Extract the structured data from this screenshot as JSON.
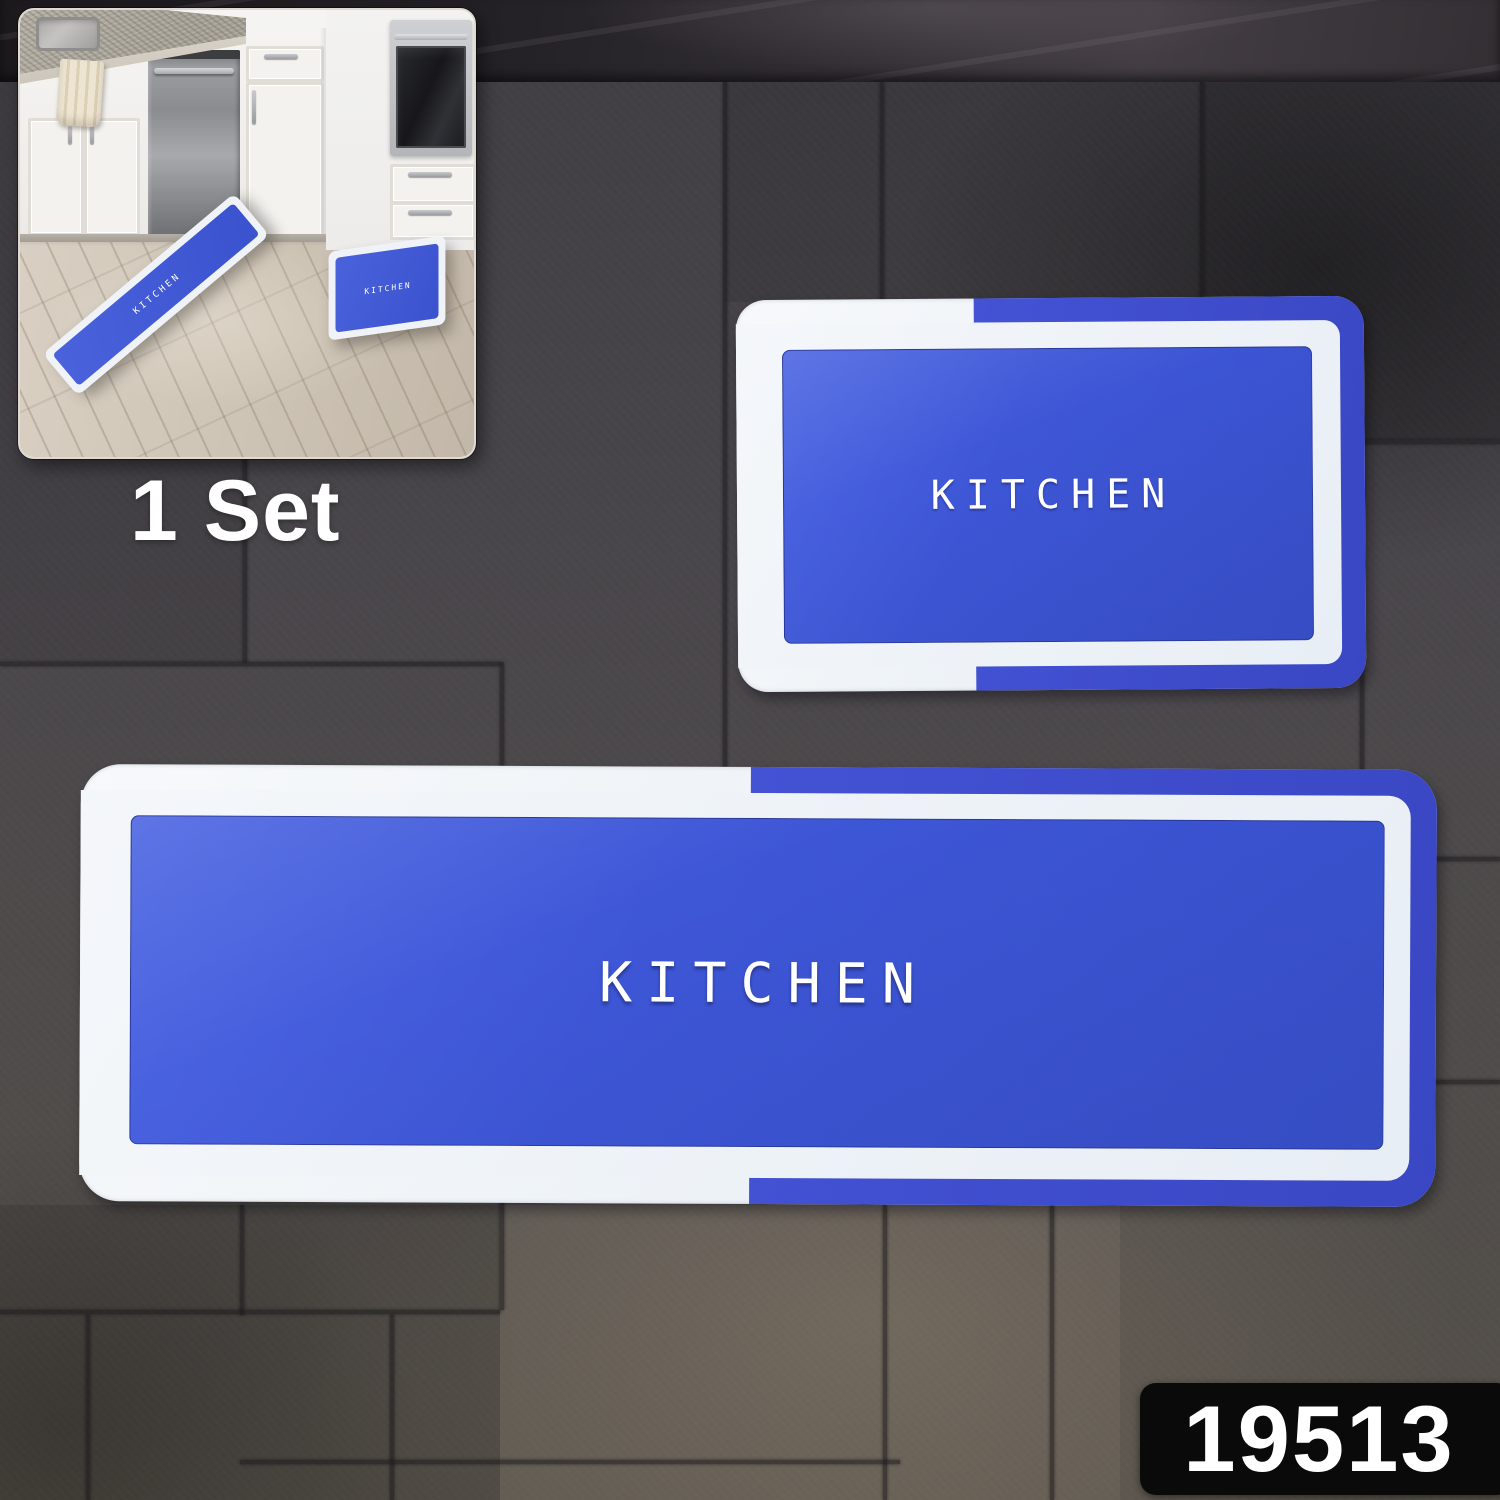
{
  "set_label": "1 Set",
  "product_code": "19513",
  "mat_large": {
    "label": "KITCHEN"
  },
  "mat_small": {
    "label": "KITCHEN"
  },
  "inset": {
    "runner_label": "KITCHEN",
    "small_mat_label": "KITCHEN"
  },
  "colors": {
    "mat_panel_blue": "#3e57d7",
    "mat_accent_blue": "#3c49c8",
    "mat_border_white": "#eef3f7",
    "tile_gray": "#4a474b",
    "marble_band": "#242226",
    "badge_bg": "#0a0a0a",
    "badge_text": "#ffffff",
    "floor_wood": "#cdc3b4"
  }
}
